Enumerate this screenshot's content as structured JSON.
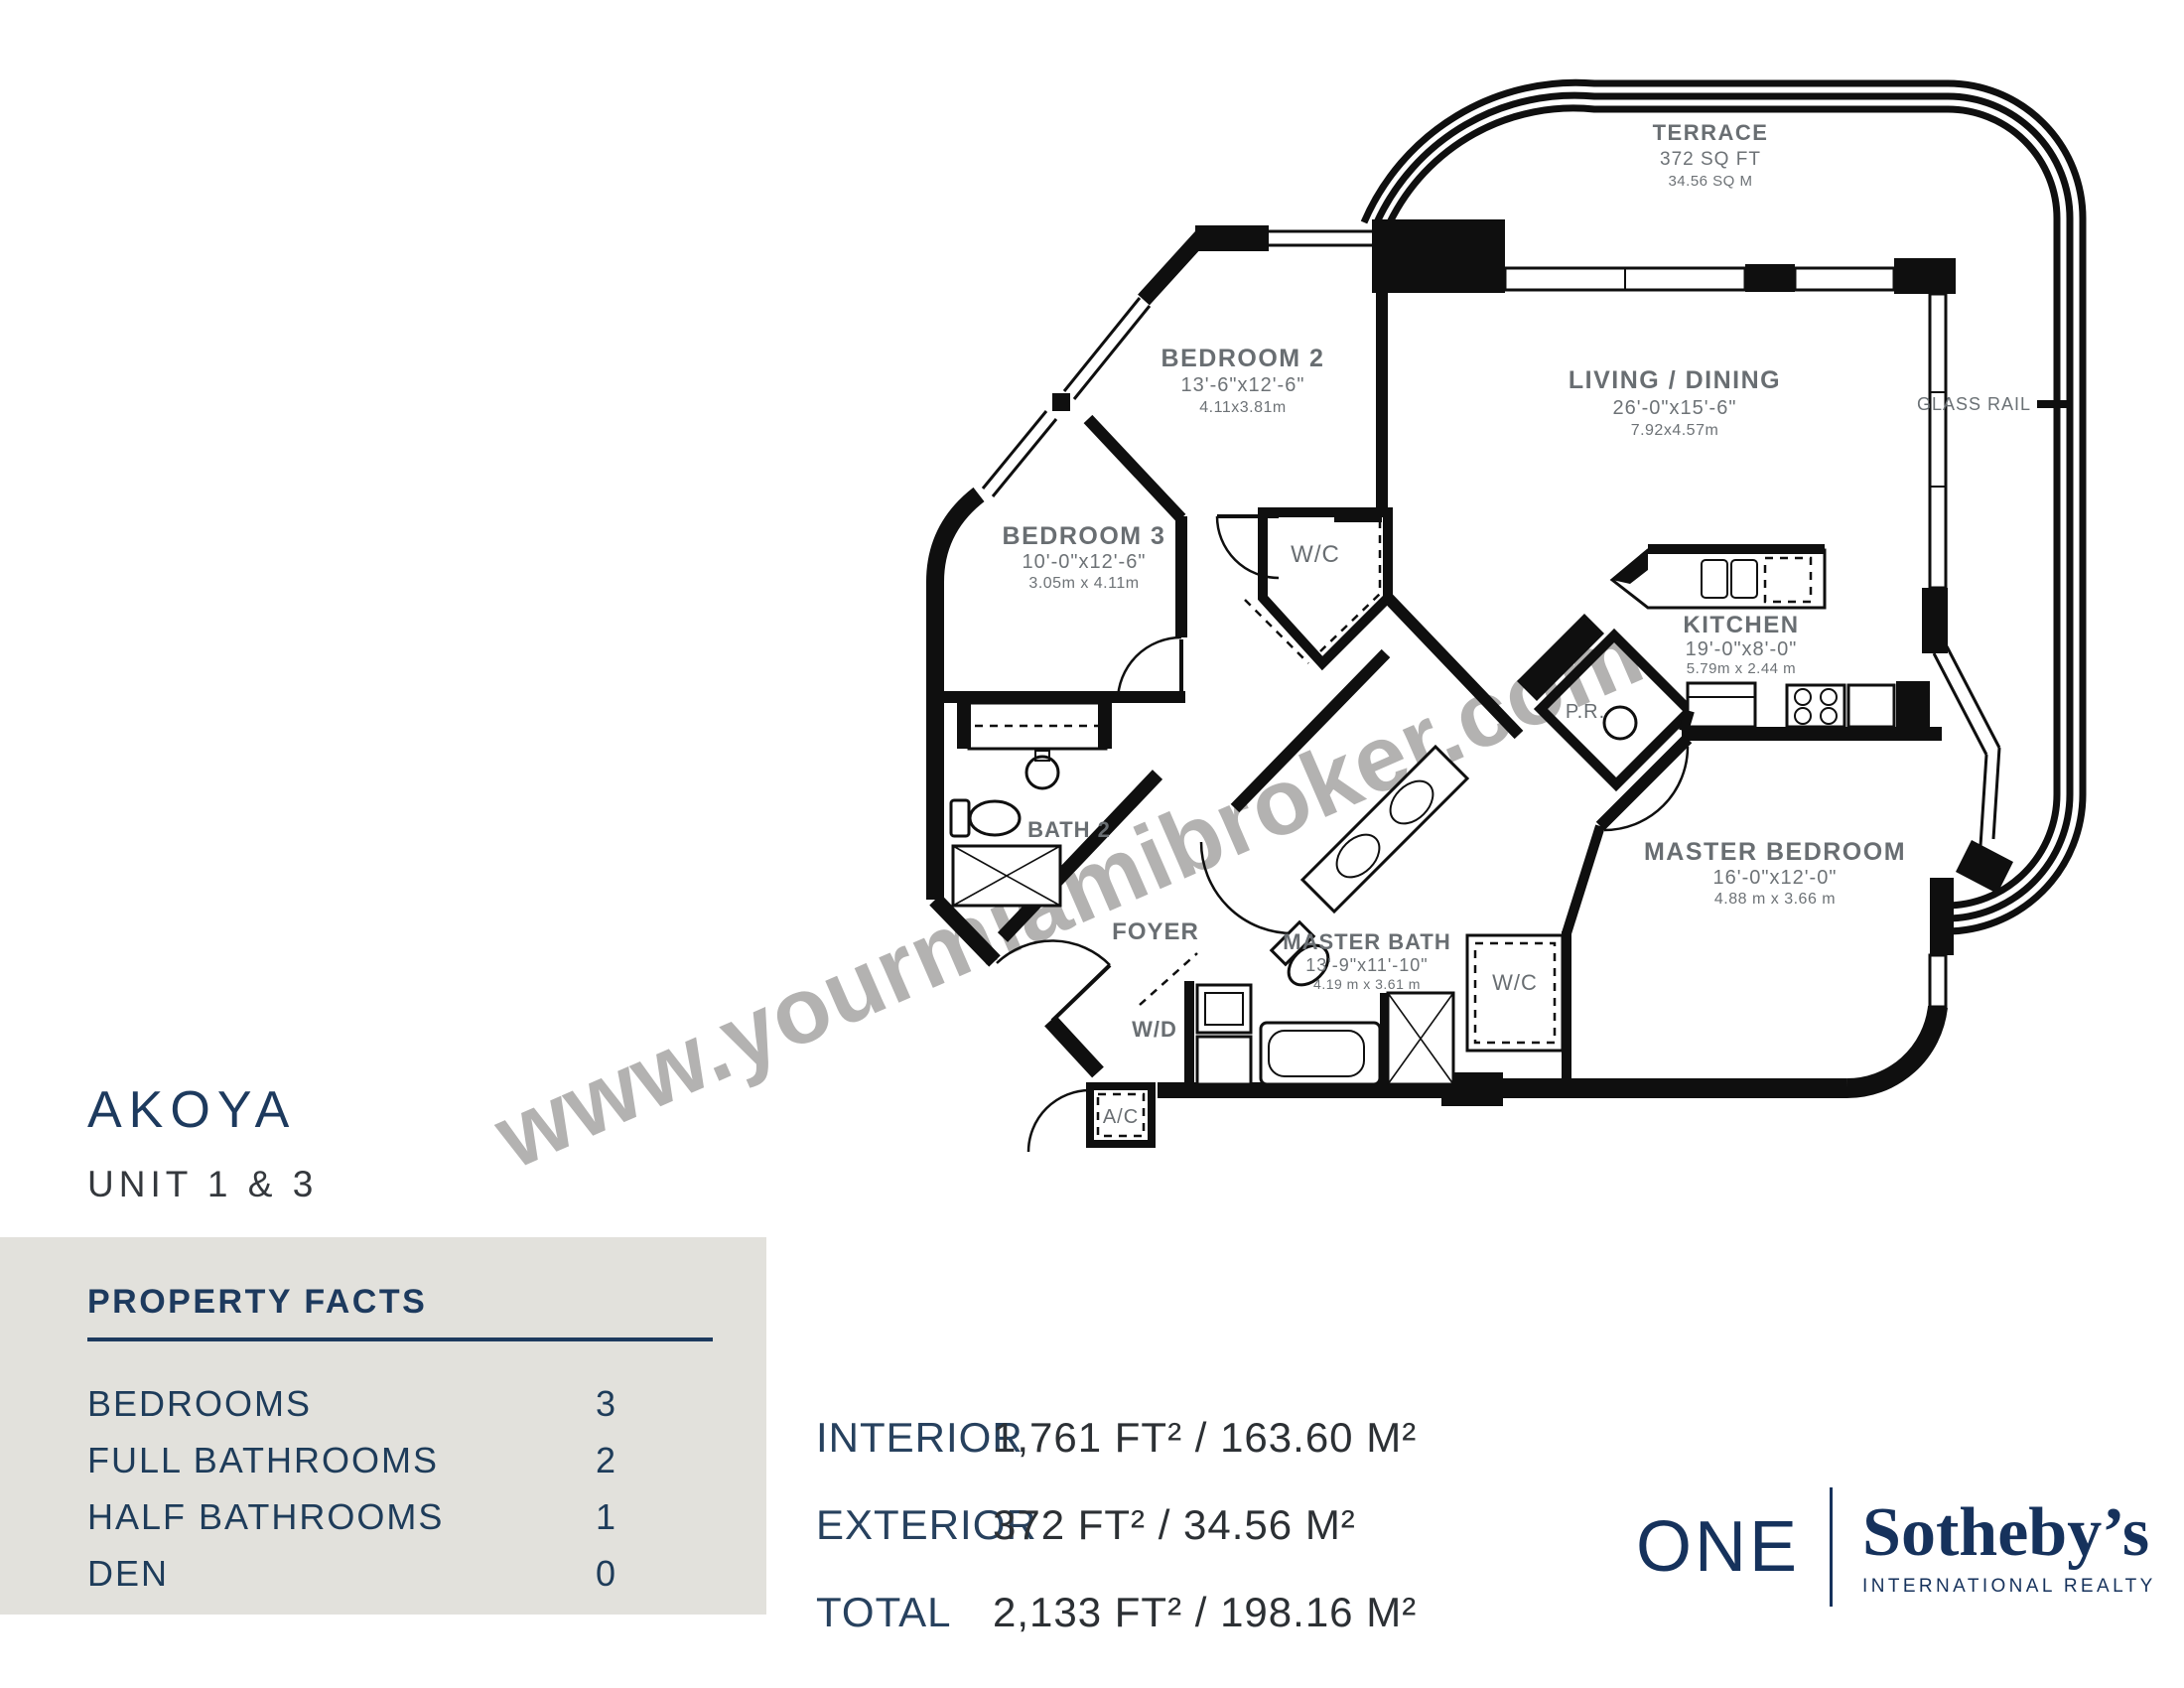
{
  "watermark": "www.yourmiamibroker.com",
  "title": {
    "building": "AKOYA",
    "unit": "UNIT 1 & 3"
  },
  "plan": {
    "rooms": [
      {
        "name": "TERRACE",
        "dims_ft": "372 SQ FT",
        "dims_m": "34.56 SQ M"
      },
      {
        "name": "BEDROOM 2",
        "dims_ft": "13'-6\"x12'-6\"",
        "dims_m": "4.11x3.81m"
      },
      {
        "name": "LIVING / DINING",
        "dims_ft": "26'-0\"x15'-6\"",
        "dims_m": "7.92x4.57m"
      },
      {
        "name": "BEDROOM 3",
        "dims_ft": "10'-0\"x12'-6\"",
        "dims_m": "3.05m x 4.11m"
      },
      {
        "name": "KITCHEN",
        "dims_ft": "19'-0\"x8'-0\"",
        "dims_m": "5.79m x 2.44 m"
      },
      {
        "name": "MASTER BEDROOM",
        "dims_ft": "16'-0\"x12'-0\"",
        "dims_m": "4.88 m x 3.66 m"
      },
      {
        "name": "MASTER BATH",
        "dims_ft": "13'-9\"x11'-10\"",
        "dims_m": "4.19 m x 3.61 m"
      }
    ],
    "labels": {
      "wc": "W/C",
      "pr": "P.R.",
      "bath2": "BATH 2",
      "foyer": "FOYER",
      "wd": "W/D",
      "ac": "A/C",
      "wc_master": "W/C",
      "glass_rail": "GLASS RAIL"
    }
  },
  "property_facts": {
    "heading": "PROPERTY FACTS",
    "rows": [
      {
        "label": "BEDROOMS",
        "value": "3"
      },
      {
        "label": "FULL BATHROOMS",
        "value": "2"
      },
      {
        "label": "HALF BATHROOMS",
        "value": "1"
      },
      {
        "label": "DEN",
        "value": "0"
      }
    ]
  },
  "areas": {
    "rows": [
      {
        "label": "INTERIOR",
        "value": "1,761 FT²  / 163.60 M²"
      },
      {
        "label": "EXTERIOR",
        "value": "372 FT²  / 34.56 M²"
      },
      {
        "label": "TOTAL",
        "value": "2,133 FT²  / 198.16 M²"
      }
    ]
  },
  "logo": {
    "one": "ONE",
    "brand": "Sotheby’s",
    "sub": "INTERNATIONAL REALTY"
  }
}
